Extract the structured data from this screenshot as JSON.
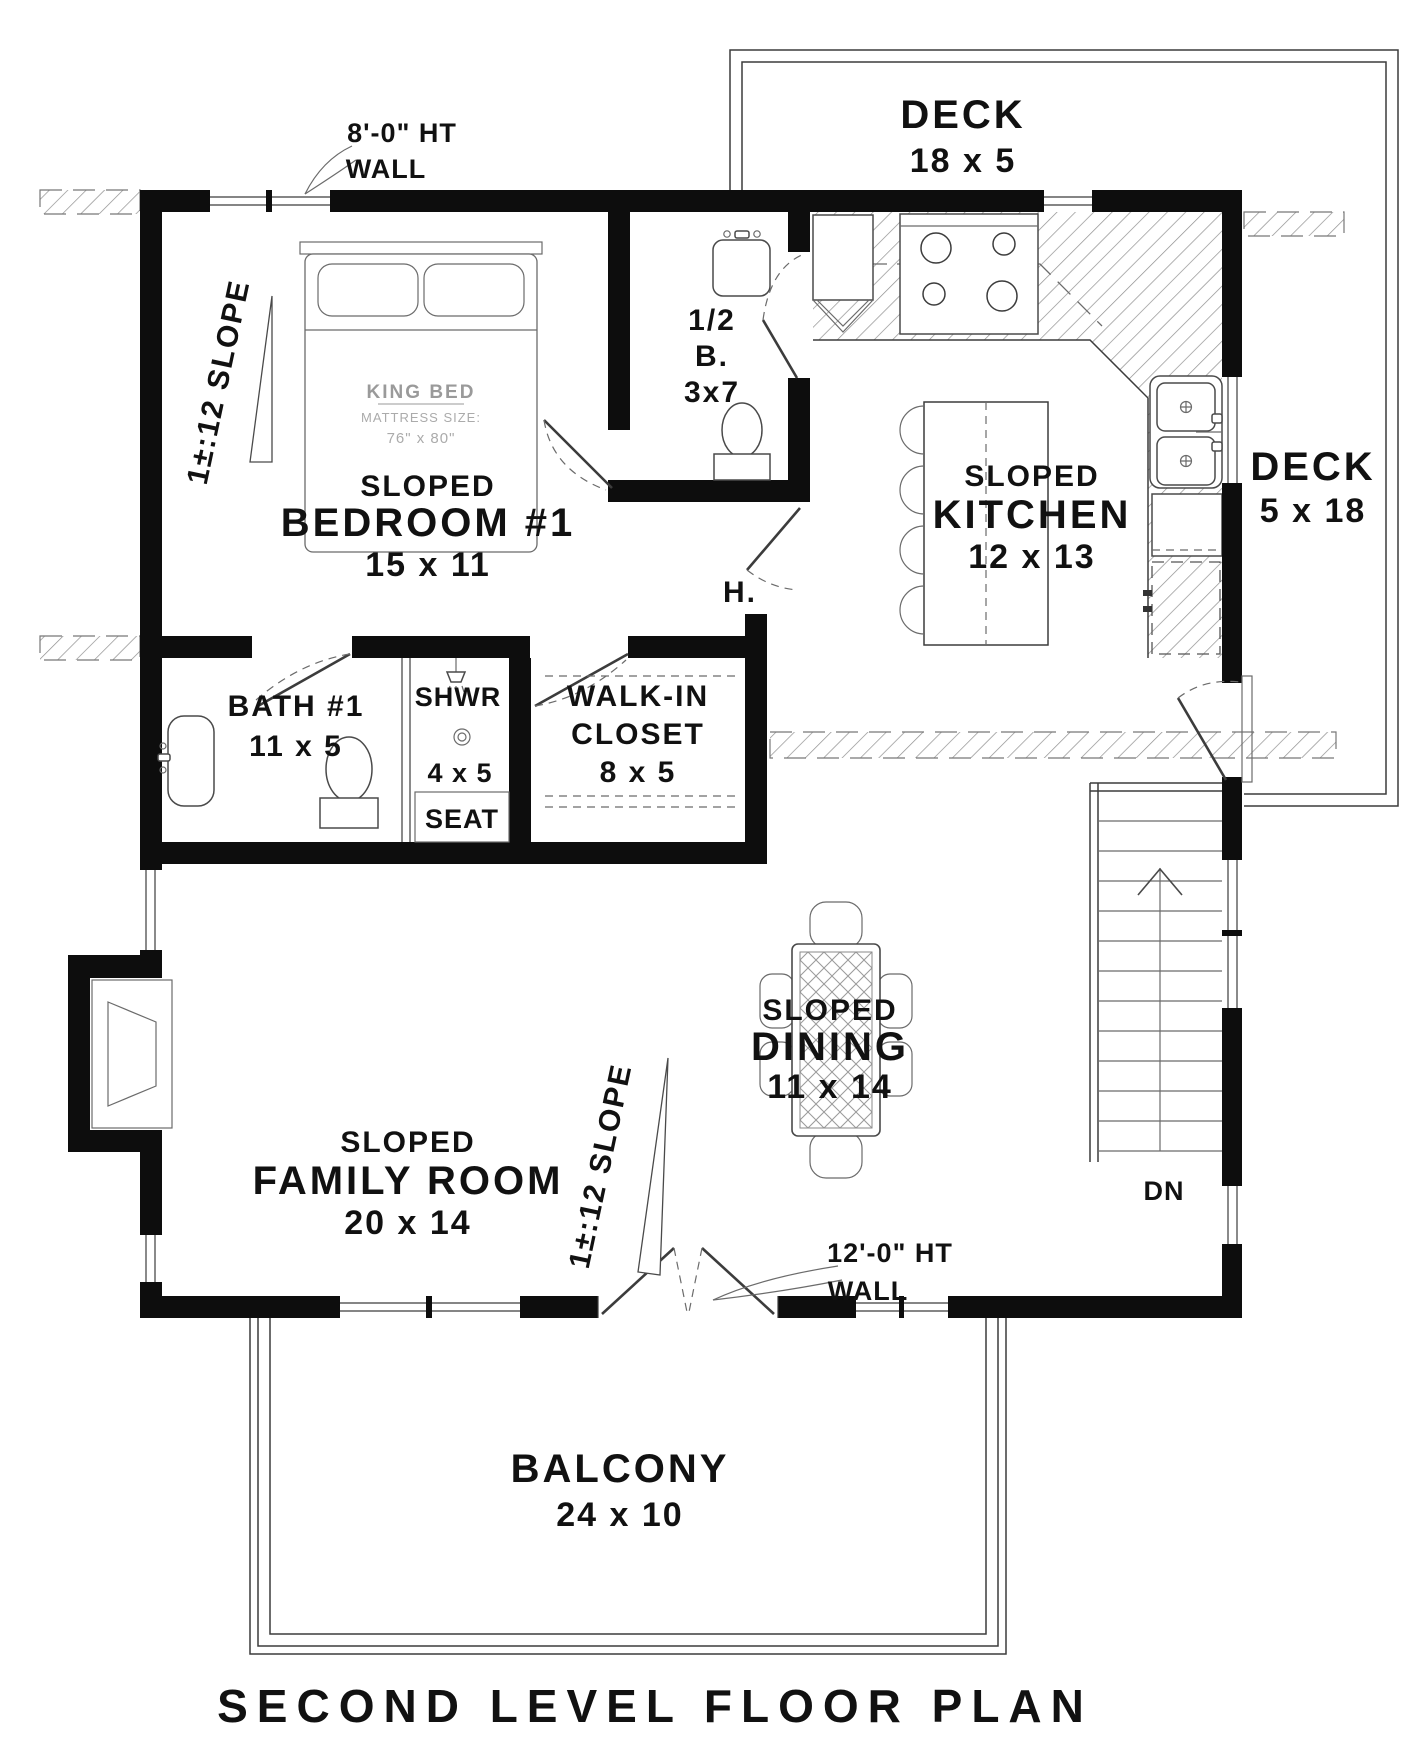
{
  "title": "SECOND LEVEL FLOOR PLAN",
  "colors": {
    "ink": "#0d0d0d",
    "grey_text": "#9a9a9a",
    "hatch": "#8f8f8f",
    "background": "#ffffff"
  },
  "decks": {
    "top": {
      "name": "DECK",
      "dims": "18 x 5"
    },
    "right": {
      "name": "DECK",
      "dims": "5 x 18"
    }
  },
  "rooms": {
    "bedroom": {
      "slope": "SLOPED",
      "name": "BEDROOM #1",
      "dims": "15 x 11"
    },
    "kitchen": {
      "slope": "SLOPED",
      "name": "KITCHEN",
      "dims": "12 x 13"
    },
    "family_room": {
      "slope": "SLOPED",
      "name": "FAMILY ROOM",
      "dims": "20 x 14"
    },
    "dining": {
      "slope": "SLOPED",
      "name": "DINING",
      "dims": "11 x 14"
    },
    "bath1": {
      "name": "BATH #1",
      "dims": "11 x 5"
    },
    "shower": {
      "name": "SHWR",
      "dims": "4 x 5",
      "seat": "SEAT"
    },
    "walk_in_closet": {
      "line1": "WALK-IN",
      "line2": "CLOSET",
      "dims": "8 x 5"
    },
    "half_bath": {
      "line1": "1/2",
      "line2": "B.",
      "dims": "3x7"
    },
    "balcony": {
      "name": "BALCONY",
      "dims": "24 x 10"
    },
    "hall": {
      "abbr": "H."
    }
  },
  "furniture": {
    "bed": {
      "label": "KING BED",
      "sub": "MATTRESS SIZE:",
      "size": "76\" x 80\""
    }
  },
  "annotations": {
    "wall8": {
      "line1": "8'-0\" HT",
      "line2": "WALL"
    },
    "wall12": {
      "line1": "12'-0\" HT",
      "line2": "WALL"
    },
    "slope_label": "1±:12 SLOPE",
    "stairs_down": "DN"
  }
}
